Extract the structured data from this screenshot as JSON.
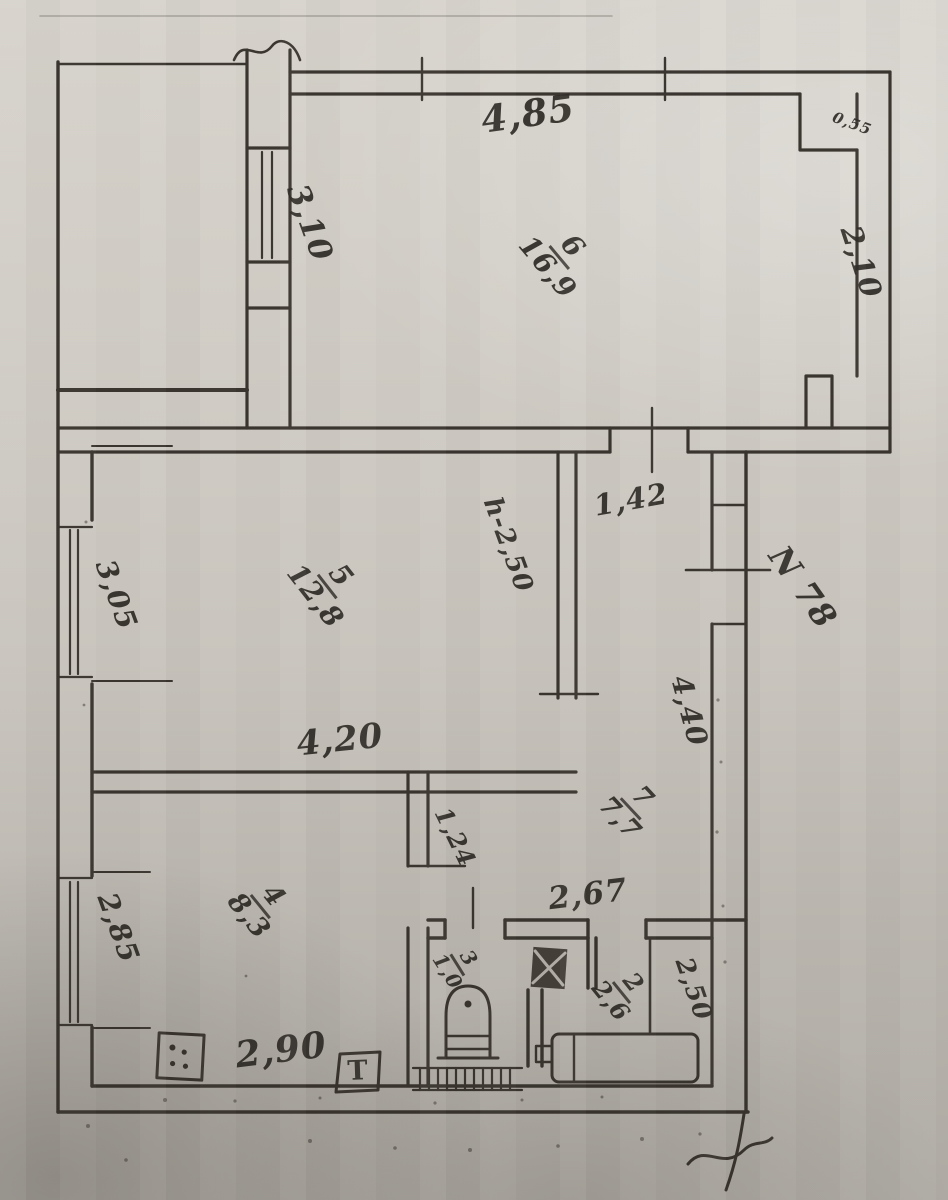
{
  "plan": {
    "apartment_no": "N 78",
    "rooms": {
      "r6": {
        "num": "6",
        "area": "16,9"
      },
      "r5": {
        "num": "5",
        "area": "12,8"
      },
      "r7": {
        "num": "7",
        "area": "7,7"
      },
      "r4": {
        "num": "4",
        "area": "8,3"
      },
      "r3": {
        "num": "3",
        "area": "1,0"
      },
      "r2": {
        "num": "2",
        "area": "2,6"
      }
    },
    "dims": {
      "top_width": "4,85",
      "right_notch": "0,55",
      "room6_left": "3,10",
      "room6_right": "2,10",
      "hall_width": "1,42",
      "ceiling_height": "h-2,50",
      "room5_left": "3,05",
      "room5_width": "4,20",
      "entry_corridor": "4,40",
      "door_offset": "1,24",
      "bath_block_width": "2,67",
      "kitchen_left": "2,85",
      "kitchen_width": "2,90",
      "bath_depth": "2,50"
    },
    "symbols": {
      "heat_marker": "Т"
    }
  },
  "colors": {
    "paper": "#ccc8c1",
    "paper_shadow": "#b0aca5",
    "ink": "#332e28"
  }
}
